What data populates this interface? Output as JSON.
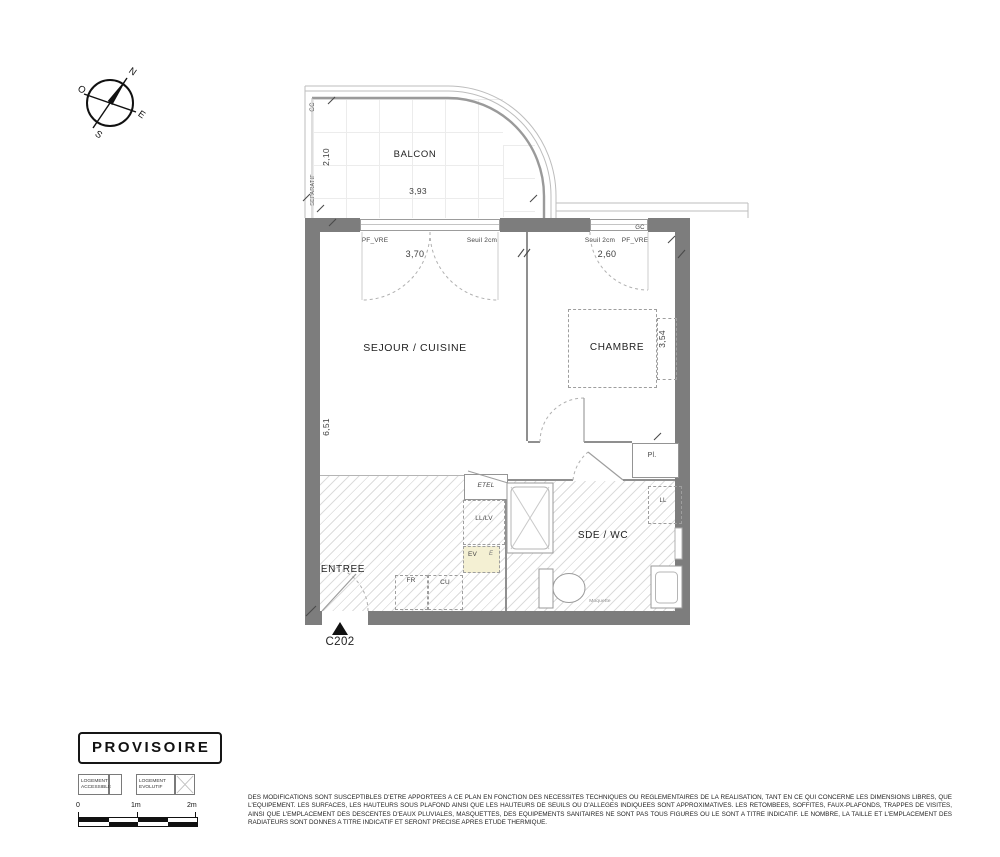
{
  "colors": {
    "wall": "#7d7d7d",
    "hatch_line": "#dcdcdc",
    "ev_highlight": "#f4f0d3",
    "linework": "#9a9a9a",
    "stamp_border": "#161616"
  },
  "compass": {
    "n": "N",
    "o": "O",
    "e": "E",
    "s": "S"
  },
  "plan": {
    "unit": "C202",
    "rooms": {
      "balcon": "BALCON",
      "sejour": "SEJOUR / CUISINE",
      "chambre": "CHAMBRE",
      "sde": "SDE / WC",
      "entree": "ENTREE"
    },
    "dims": {
      "balcon_depth": "2,10",
      "balcon_width": "3,93",
      "sejour_width": "3,70",
      "chambre_width": "2,60",
      "left_height": "6,51",
      "chambre_height": "3,54"
    },
    "ann": {
      "gc_balcon": "GC",
      "gc_right": "GC",
      "separatif": "SEPARATIF",
      "pf_vre_left": "PF_VRE",
      "seuil_left": "Seuil 2cm",
      "seuil_right": "Seuil 2cm",
      "pf_vre_right": "PF_VRE",
      "etel": "ETEL",
      "lllv": "LL/LV",
      "ev": "EV",
      "ev_e": "E",
      "fr": "FR",
      "cu": "CU",
      "pl": "Pl.",
      "ll": "LL",
      "moquette": "Moquette"
    }
  },
  "stamp": {
    "label": "PROVISOIRE"
  },
  "legend": {
    "accessible_l1": "LOGEMENT",
    "accessible_l2": "ACCESSIBLE",
    "evolutif_l1": "LOGEMENT",
    "evolutif_l2": "EVOLUTIF"
  },
  "scalebar": {
    "t0": "0",
    "t1": "1m",
    "t2": "2m"
  },
  "disclaimer": {
    "text": "DES MODIFICATIONS SONT SUSCEPTIBLES D'ETRE APPORTEES A CE PLAN EN FONCTION DES NECESSITES TECHNIQUES OU REGLEMENTAIRES DE LA REALISATION, TANT EN CE QUI CONCERNE LES DIMENSIONS LIBRES, QUE L'EQUIPEMENT. LES SURFACES, LES HAUTEURS SOUS PLAFOND AINSI QUE LES HAUTEURS DE SEUILS OU D'ALLEGES INDIQUEES SONT APPROXIMATIVES. LES RETOMBEES, SOFFITES, FAUX-PLAFONDS, TRAPPES DE VISITES, AINSI QUE L'EMPLACEMENT DES DESCENTES D'EAUX PLUVIALES, MASQUETTES, DES EQUIPEMENTS SANITAIRES NE SONT PAS TOUS FIGURES OU LE SONT A TITRE INDICATIF. LE NOMBRE, LA TAILLE ET L'EMPLACEMENT DES RADIATEURS SONT DONNES A TITRE INDICATIF ET SERONT PRECISE APRES ETUDE THERMIQUE."
  }
}
